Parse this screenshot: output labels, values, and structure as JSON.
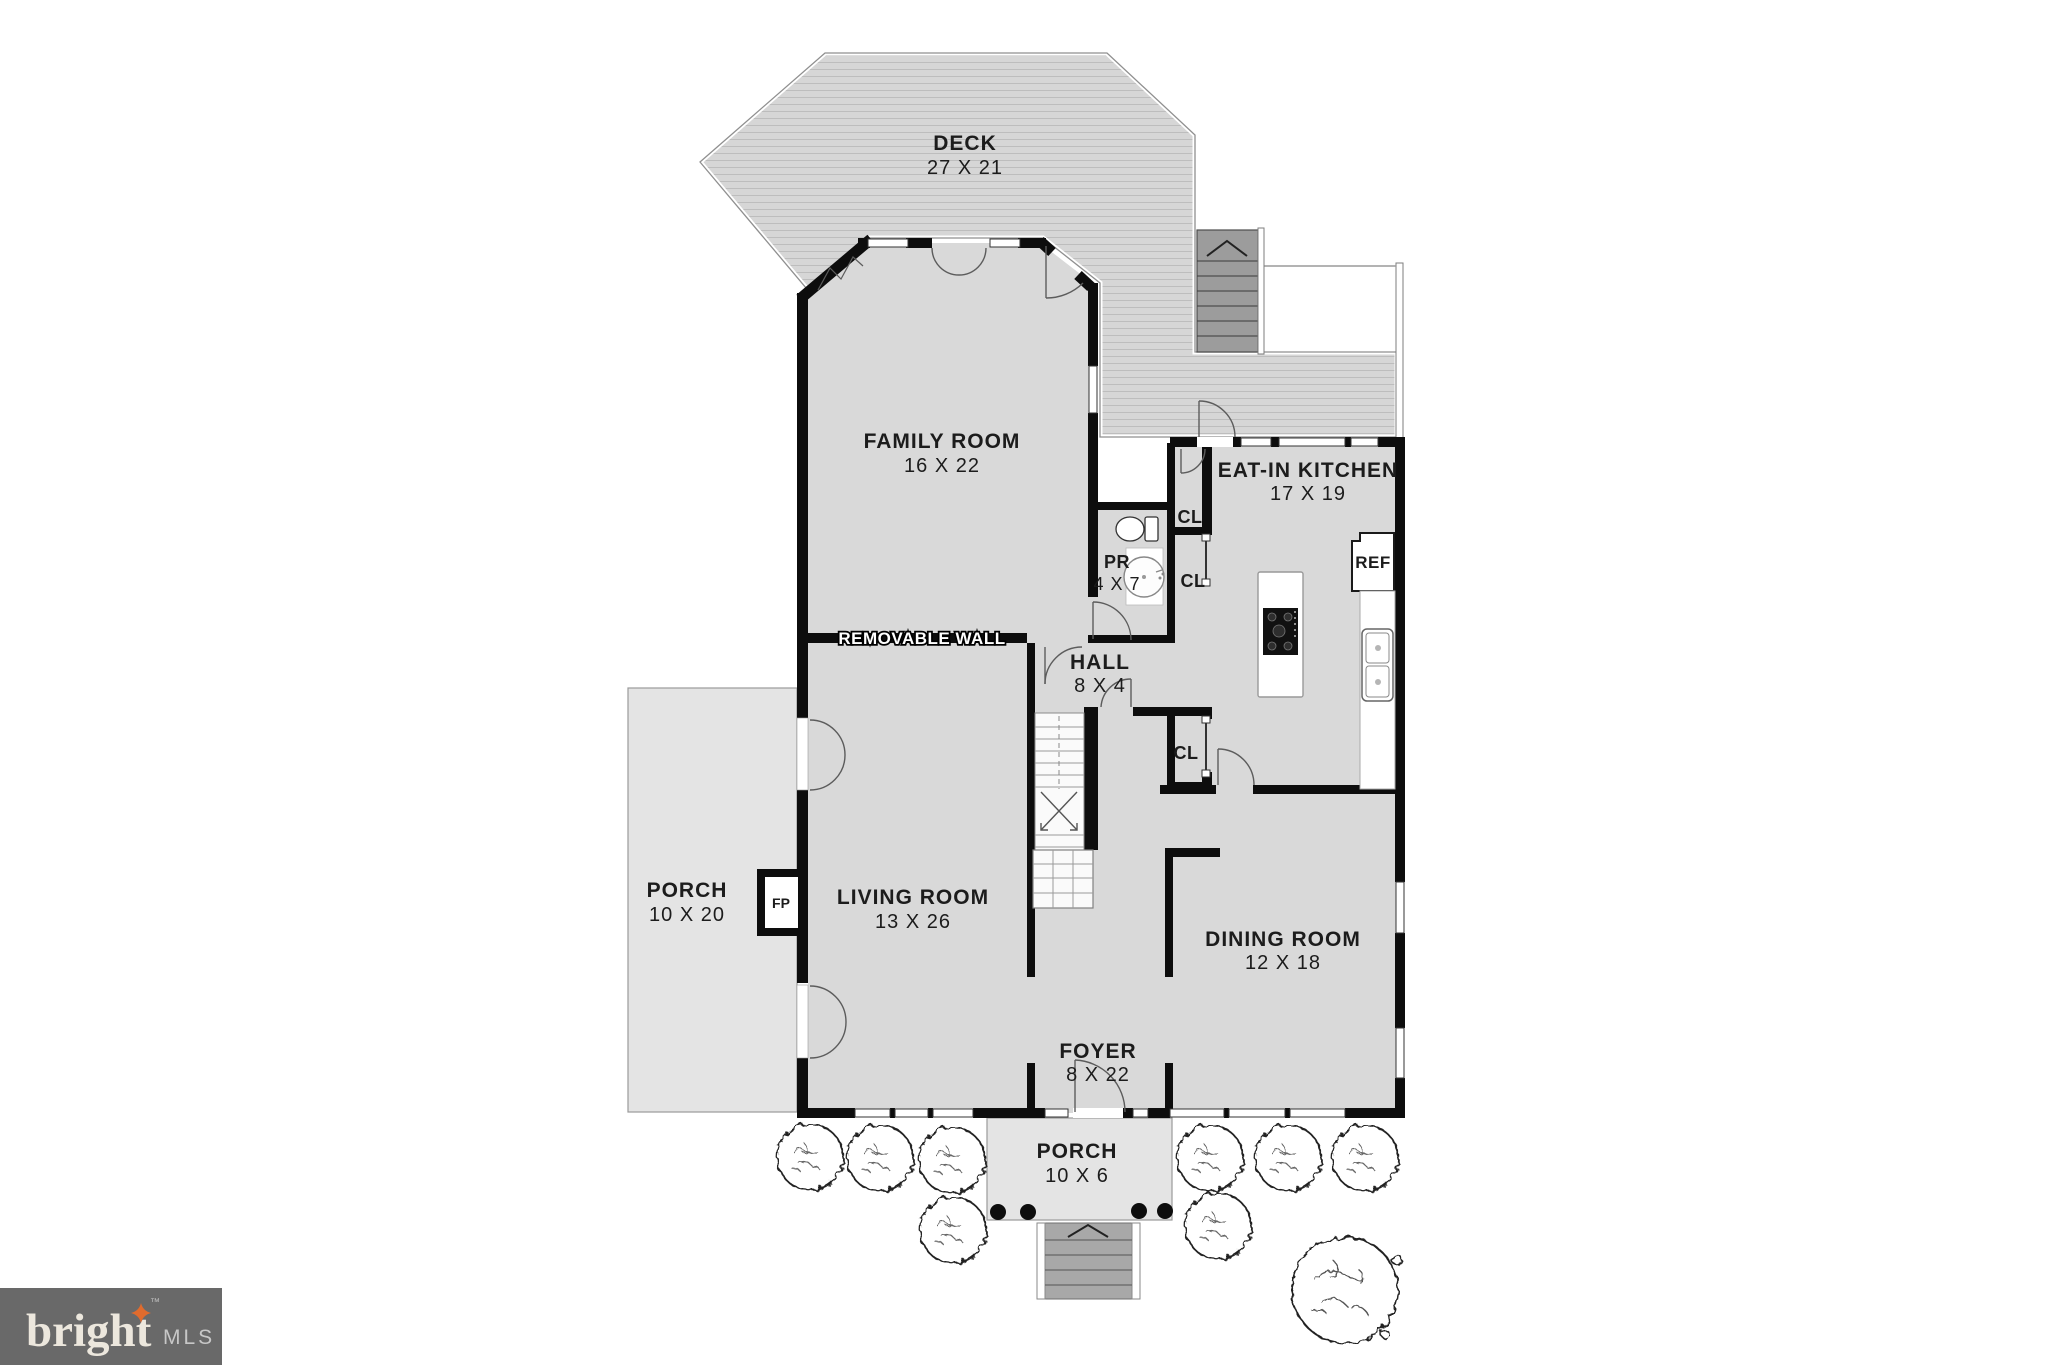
{
  "watermark": {
    "brand": "bright",
    "tm": "™",
    "mls": "MLS"
  },
  "rooms": {
    "deck": {
      "name": "DECK",
      "dims": "27 X 21"
    },
    "family_room": {
      "name": "FAMILY ROOM",
      "dims": "16 X 22"
    },
    "eat_in_kitchen": {
      "name": "EAT-IN KITCHEN",
      "dims": "17 X 19"
    },
    "powder_room": {
      "name": "PR",
      "dims": "4 X 7"
    },
    "hall": {
      "name": "HALL",
      "dims": "8 X 4"
    },
    "living_room": {
      "name": "LIVING ROOM",
      "dims": "13 X 26"
    },
    "dining_room": {
      "name": "DINING ROOM",
      "dims": "12 X 18"
    },
    "foyer": {
      "name": "FOYER",
      "dims": "8 X 22"
    },
    "side_porch": {
      "name": "PORCH",
      "dims": "10 X 20"
    },
    "front_porch": {
      "name": "PORCH",
      "dims": "10 X 6"
    }
  },
  "annotations": {
    "removable_wall": "REMOVABLE WALL",
    "fireplace": "FP",
    "refrigerator": "REF"
  },
  "closets": {
    "c1": "CL",
    "c2": "CL",
    "c3": "CL"
  },
  "colors": {
    "wall": "#0d0d0d",
    "floor": "#d9d9d9",
    "porch": "#e4e4e4",
    "deck": "#d6d6d6",
    "deck_line": "#bdbdbd",
    "stairs_dark": "#9c9c9c",
    "logo_bg": "#696969",
    "logo_text": "#ece7dd",
    "logo_star": "#e06b2d",
    "logo_mls": "#c7c7c7",
    "label": "#1c1c1c"
  }
}
